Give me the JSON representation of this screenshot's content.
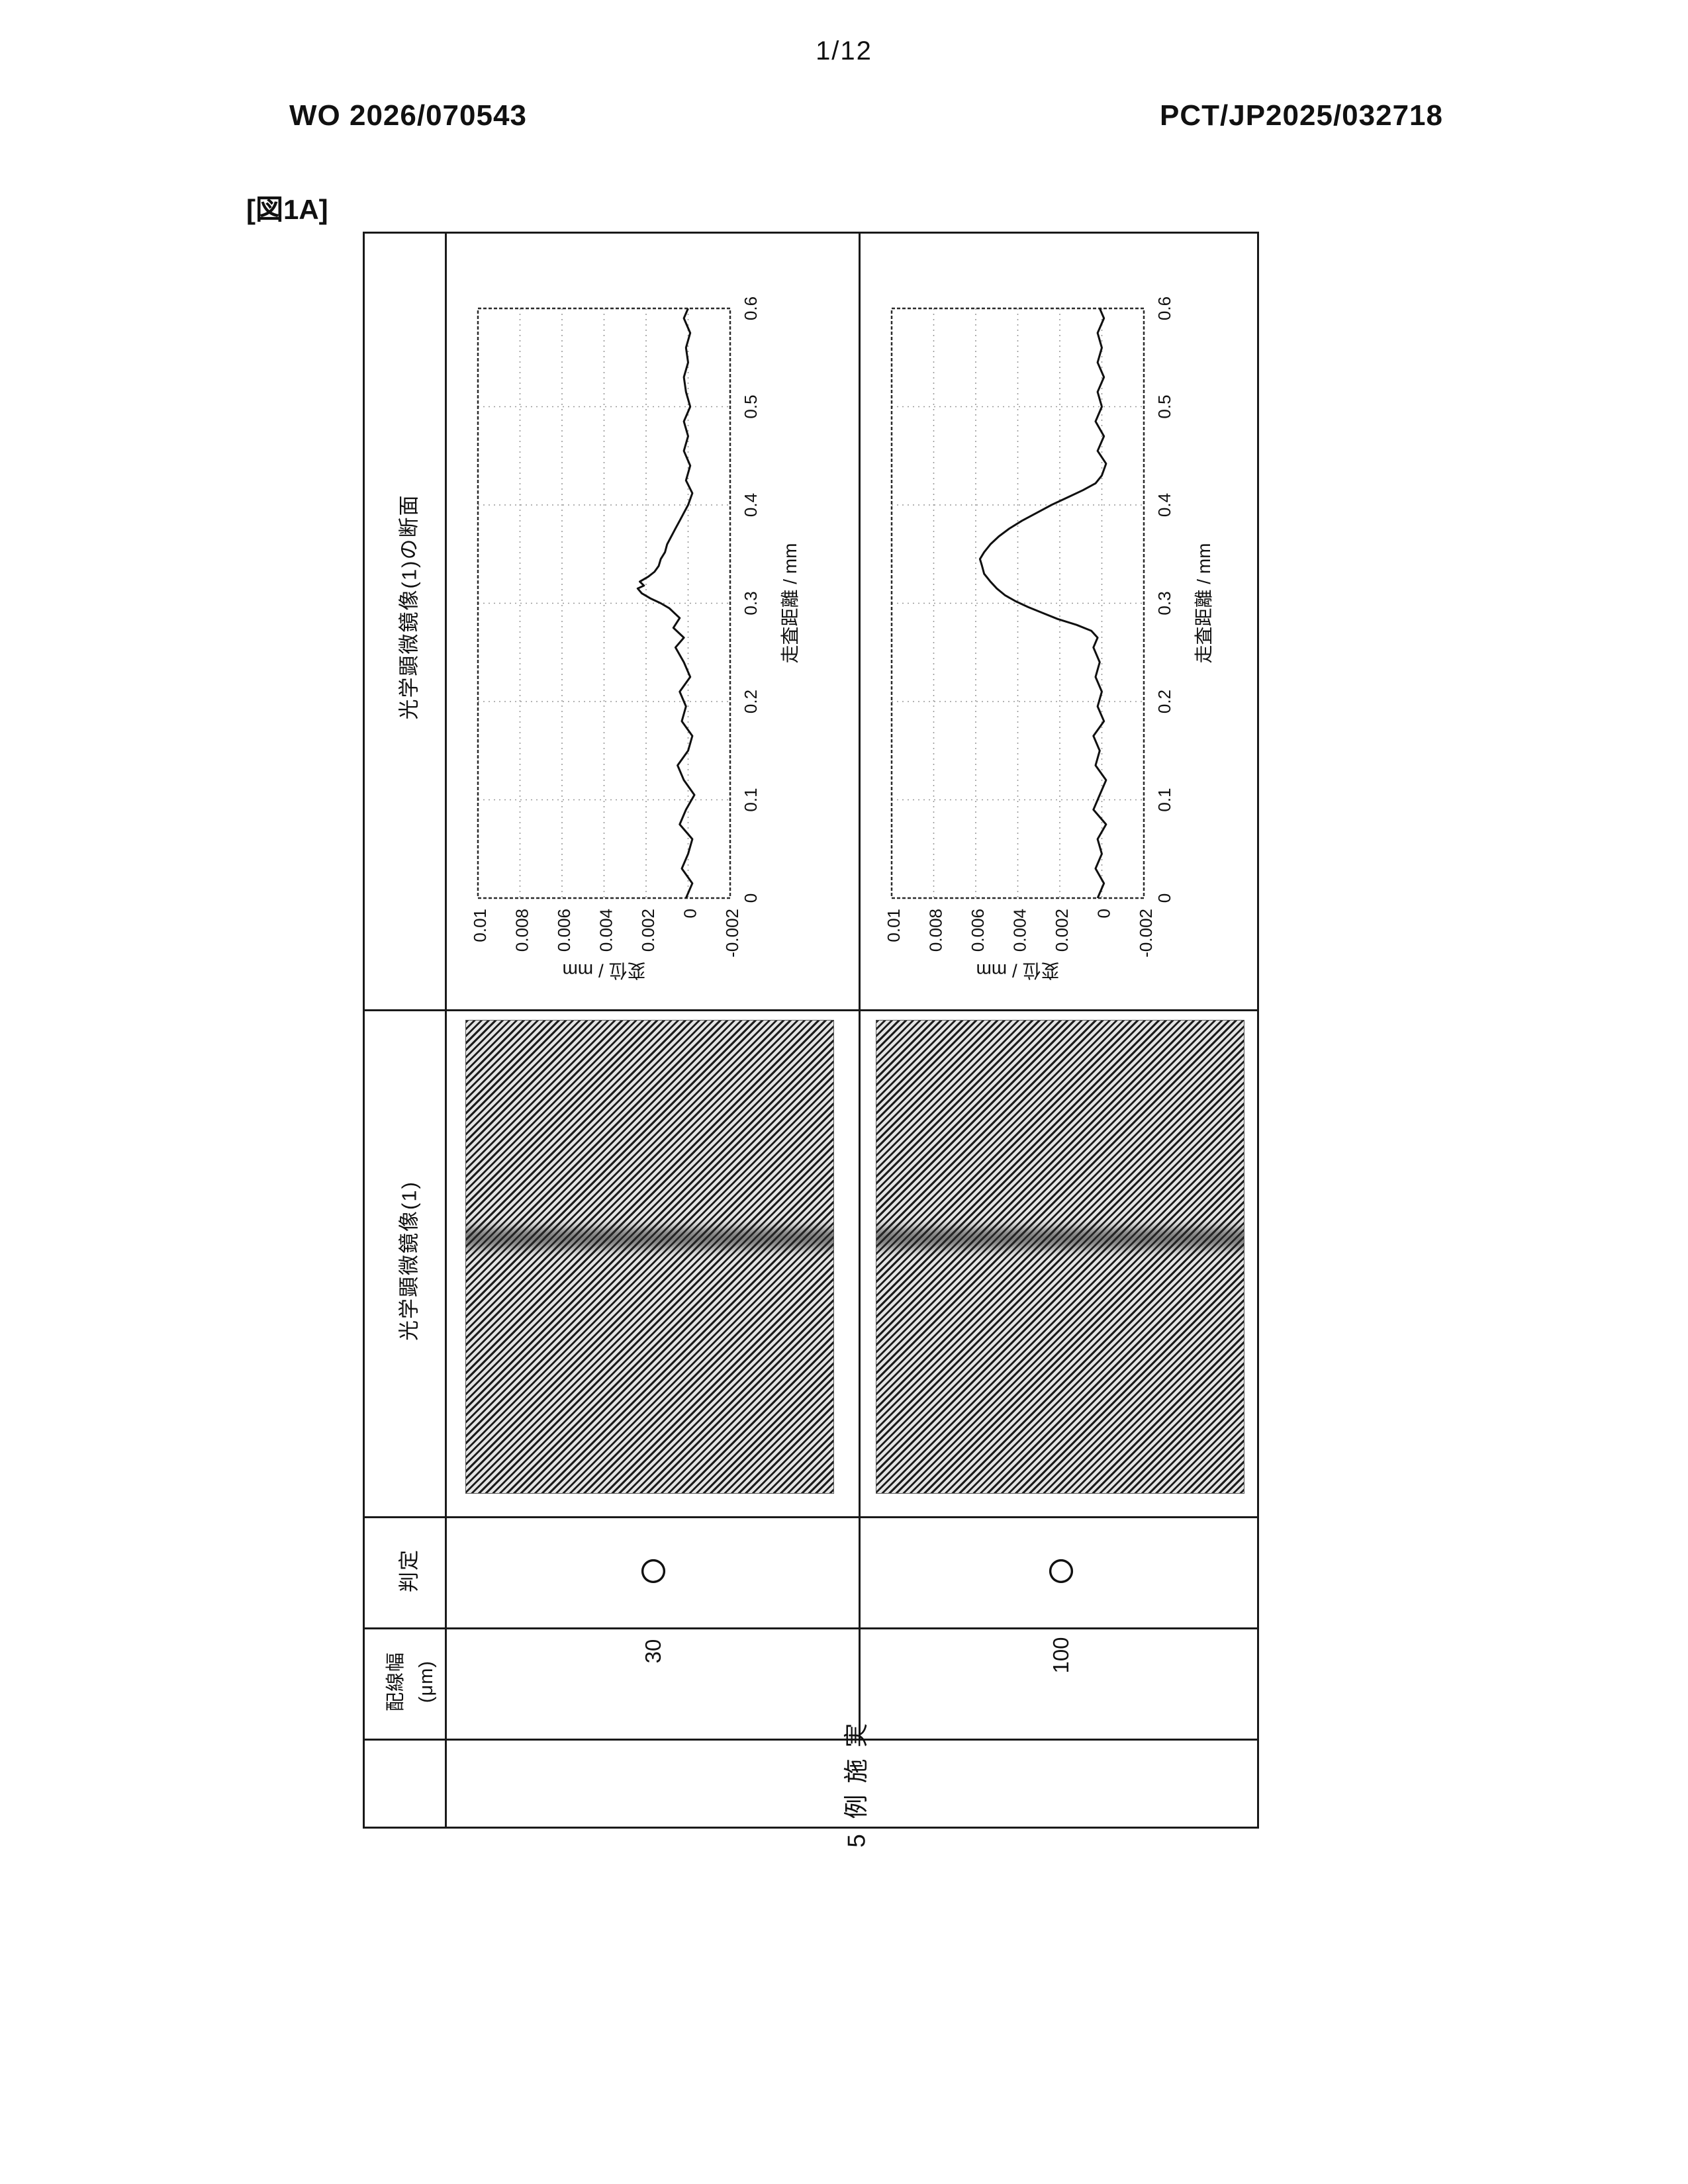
{
  "page": {
    "page_number": "1/12",
    "publication_number": "WO 2026/070543",
    "application_number": "PCT/JP2025/032718",
    "figure_label": "[図1A]"
  },
  "table": {
    "example_row_header": "実施例5",
    "headers": {
      "line_width": "配線幅",
      "line_width_unit": "(μm)",
      "judgment": "判定",
      "micrograph": "光学顕微鏡像(1)",
      "cross_section": "光学顕微鏡像(1)の断面"
    },
    "rows": [
      {
        "line_width": "30",
        "judgment": "○"
      },
      {
        "line_width": "100",
        "judgment": "○"
      }
    ]
  },
  "chart_data": [
    {
      "type": "line",
      "row_line_width_um": 30,
      "xlabel": "走査距離 / mm",
      "ylabel": "変位 / mm",
      "xlim": [
        0,
        0.6
      ],
      "ylim": [
        -0.002,
        0.01
      ],
      "xtick_labels": [
        "0",
        "0.1",
        "0.2",
        "0.3",
        "0.4",
        "0.5",
        "0.6"
      ],
      "ytick_labels": [
        "0.01",
        "0.008",
        "0.006",
        "0.004",
        "0.002",
        "0",
        "-0.002"
      ],
      "grid": true,
      "x": [
        0.0,
        0.015,
        0.03,
        0.045,
        0.06,
        0.075,
        0.09,
        0.105,
        0.12,
        0.135,
        0.15,
        0.165,
        0.18,
        0.195,
        0.21,
        0.225,
        0.24,
        0.255,
        0.265,
        0.275,
        0.285,
        0.295,
        0.3,
        0.305,
        0.31,
        0.315,
        0.318,
        0.322,
        0.327,
        0.332,
        0.338,
        0.345,
        0.352,
        0.36,
        0.368,
        0.376,
        0.384,
        0.392,
        0.4,
        0.412,
        0.425,
        0.44,
        0.455,
        0.47,
        0.485,
        0.5,
        0.515,
        0.53,
        0.545,
        0.56,
        0.575,
        0.59,
        0.6
      ],
      "y": [
        0.0001,
        -0.0002,
        0.0003,
        0.0,
        -0.0002,
        0.0004,
        0.0001,
        -0.0003,
        0.0002,
        0.0005,
        0.0,
        -0.0002,
        0.0003,
        0.0001,
        0.0004,
        -0.0001,
        0.0002,
        0.0006,
        0.0002,
        0.0007,
        0.0004,
        0.0009,
        0.0013,
        0.0018,
        0.0022,
        0.0024,
        0.0021,
        0.0023,
        0.0019,
        0.0016,
        0.0014,
        0.0013,
        0.0011,
        0.001,
        0.0008,
        0.0006,
        0.0004,
        0.0002,
        0.0,
        -0.0002,
        0.0001,
        -0.0001,
        0.0002,
        0.0,
        0.0002,
        -0.0001,
        0.0001,
        0.0002,
        0.0,
        0.0001,
        -0.0001,
        0.0002,
        0.0
      ]
    },
    {
      "type": "line",
      "row_line_width_um": 100,
      "xlabel": "走査距離 / mm",
      "ylabel": "変位 / mm",
      "xlim": [
        0,
        0.6
      ],
      "ylim": [
        -0.002,
        0.01
      ],
      "xtick_labels": [
        "0",
        "0.1",
        "0.2",
        "0.3",
        "0.4",
        "0.5",
        "0.6"
      ],
      "ytick_labels": [
        "0.01",
        "0.008",
        "0.006",
        "0.004",
        "0.002",
        "0",
        "-0.002"
      ],
      "grid": true,
      "x": [
        0.0,
        0.015,
        0.03,
        0.045,
        0.06,
        0.075,
        0.09,
        0.105,
        0.12,
        0.135,
        0.15,
        0.165,
        0.18,
        0.195,
        0.21,
        0.225,
        0.24,
        0.255,
        0.265,
        0.272,
        0.278,
        0.284,
        0.29,
        0.296,
        0.302,
        0.308,
        0.315,
        0.322,
        0.33,
        0.338,
        0.345,
        0.352,
        0.36,
        0.368,
        0.376,
        0.384,
        0.392,
        0.4,
        0.408,
        0.415,
        0.422,
        0.43,
        0.442,
        0.455,
        0.47,
        0.485,
        0.5,
        0.515,
        0.53,
        0.545,
        0.56,
        0.575,
        0.59,
        0.6
      ],
      "y": [
        0.0002,
        -0.0001,
        0.0003,
        0.0,
        0.0002,
        -0.0002,
        0.0004,
        0.0001,
        -0.0002,
        0.0003,
        0.0001,
        0.0004,
        -0.0001,
        0.0002,
        0.0,
        0.0003,
        0.0001,
        0.0004,
        0.0002,
        0.0005,
        0.0012,
        0.0021,
        0.0028,
        0.0035,
        0.0041,
        0.0046,
        0.005,
        0.0053,
        0.0056,
        0.0057,
        0.0058,
        0.0056,
        0.0053,
        0.0049,
        0.0044,
        0.0038,
        0.0031,
        0.0024,
        0.0016,
        0.0009,
        0.0003,
        0.0,
        -0.0002,
        0.0002,
        -0.0001,
        0.0003,
        0.0,
        0.0002,
        -0.0001,
        0.0002,
        0.0,
        0.0002,
        -0.0001,
        0.0001
      ]
    }
  ]
}
